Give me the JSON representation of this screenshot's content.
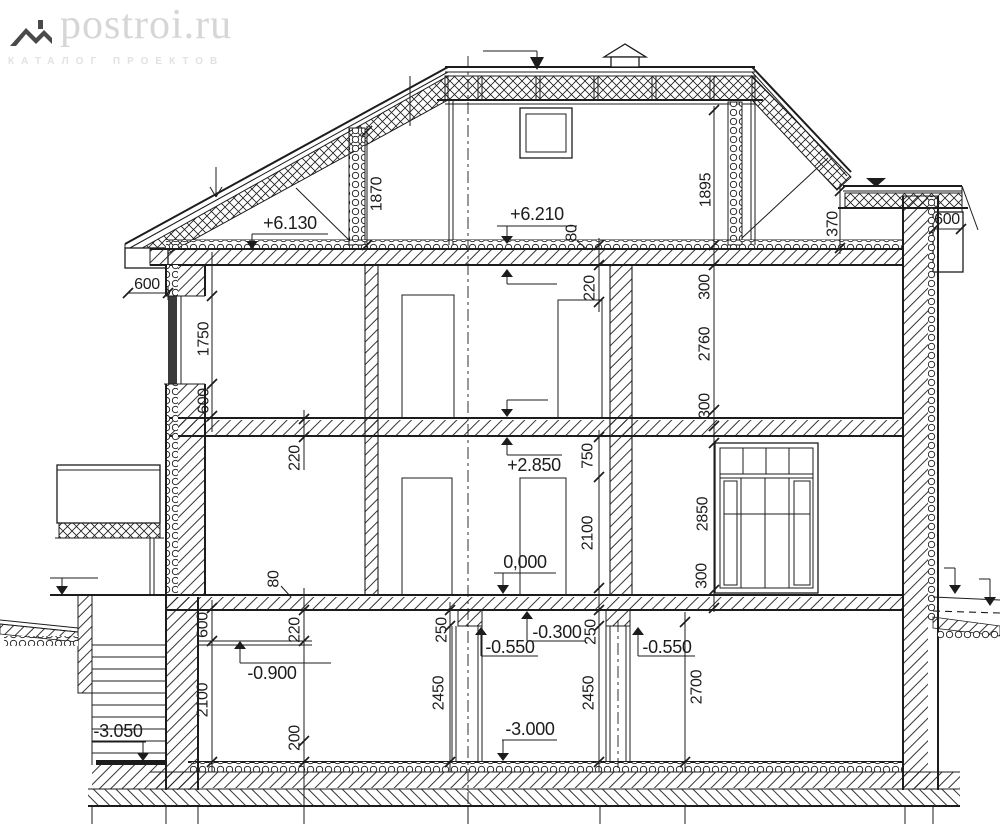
{
  "logo": {
    "brand": "postroi.ru",
    "tagline": "КАТАЛОГ ПРОЕКТОВ"
  },
  "colors": {
    "ink": "#1c1c1c",
    "paper": "#ffffff",
    "logo_brand": "#d6d6d6",
    "logo_tagline": "#e2e2e2",
    "logo_icon": "#4a4a4a",
    "window_glazing": "#3a3a3a"
  },
  "levels": {
    "attic_floor": "+6.130",
    "attic_slab": "+6.210",
    "floor2": "+2.850",
    "ground": "0,000",
    "slab_bottom": "-0.300",
    "beam_left": "-0.550",
    "beam_right": "-0.550",
    "garage": "-0.900",
    "basement": "-3.000",
    "stair_pit": "-3.050"
  },
  "dimensions": {
    "attic_left_height": "1870",
    "attic_right_height": "1895",
    "roof_offset": "370",
    "eaves_left": "600",
    "eaves_right": "600",
    "window_left_height": "1750",
    "sill_left": "600",
    "slab2_thickness": "220",
    "attic_slab_thickness": "80",
    "attic_ceiling": "220",
    "floor2_top": "300",
    "floor2_room": "2760",
    "floor2_bottom": "300",
    "parapet": "750",
    "wall_center": "2100",
    "window_right_height": "2850",
    "sill_right": "300",
    "porch_slab": "80",
    "basement_top_left": "600",
    "basement_step": "220",
    "basement_left_height": "2100",
    "basement_floor_left": "200",
    "lintel_left": "250",
    "lintel_center": "250",
    "basement_room_left": "2450",
    "basement_room_center": "2450",
    "basement_room_right": "2700"
  }
}
